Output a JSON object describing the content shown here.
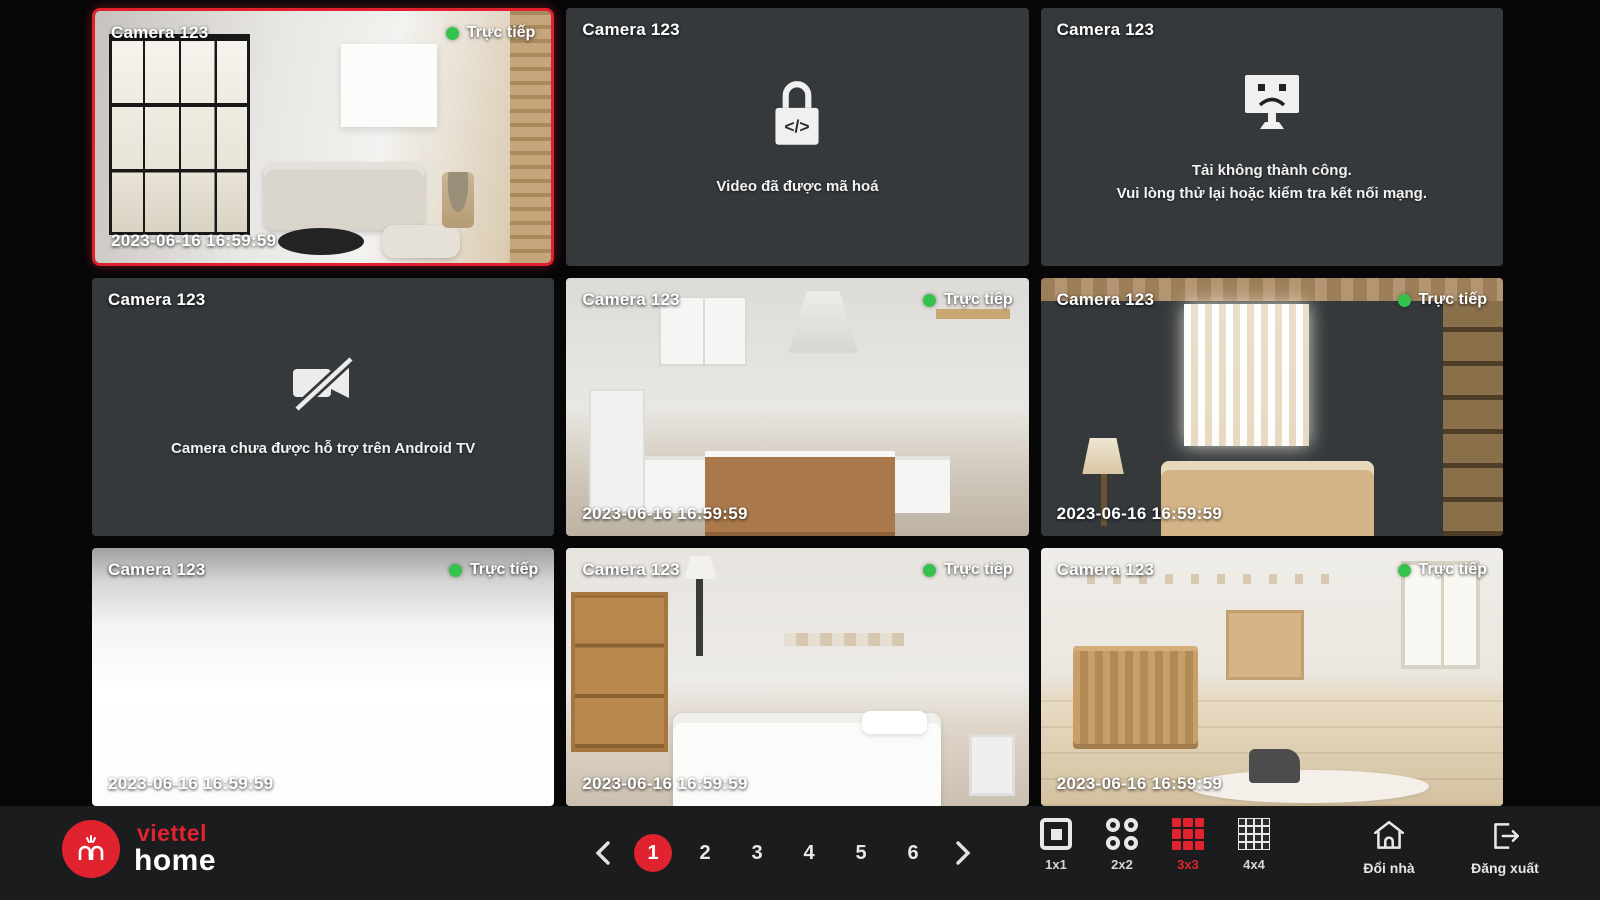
{
  "colors": {
    "accent_red": "#e0232e",
    "live_green": "#35c24c",
    "tile_gray": "#35393c"
  },
  "tiles": [
    {
      "title": "Camera 123",
      "status": "live",
      "status_label": "Trực tiếp",
      "timestamp": "2023-06-16 16:59:59",
      "selected": true
    },
    {
      "title": "Camera 123",
      "status": "encrypted",
      "message": "Video đã được mã hoá"
    },
    {
      "title": "Camera 123",
      "status": "error",
      "message_line1": "Tải không thành công.",
      "message_line2": "Vui lòng thử lại hoặc kiểm tra kết nối mạng."
    },
    {
      "title": "Camera 123",
      "status": "unsupported",
      "message": "Camera chưa được hỗ trợ trên Android TV"
    },
    {
      "title": "Camera 123",
      "status": "live",
      "status_label": "Trực tiếp",
      "timestamp": "2023-06-16 16:59:59"
    },
    {
      "title": "Camera 123",
      "status": "live",
      "status_label": "Trực tiếp",
      "timestamp": "2023-06-16 16:59:59"
    },
    {
      "title": "Camera 123",
      "status": "live",
      "status_label": "Trực tiếp",
      "timestamp": "2023-06-16 16:59:59"
    },
    {
      "title": "Camera 123",
      "status": "live",
      "status_label": "Trực tiếp",
      "timestamp": "2023-06-16 16:59:59"
    },
    {
      "title": "Camera 123",
      "status": "live",
      "status_label": "Trực tiếp",
      "timestamp": "2023-06-16 16:59:59"
    }
  ],
  "icons": {
    "code_glyph": "</>"
  },
  "footer": {
    "brand": {
      "word1": "viettel",
      "word2": "home"
    },
    "pagination": {
      "pages": [
        "1",
        "2",
        "3",
        "4",
        "5",
        "6"
      ],
      "active_page": "1"
    },
    "layouts": [
      {
        "label": "1x1"
      },
      {
        "label": "2x2"
      },
      {
        "label": "3x3",
        "active": true
      },
      {
        "label": "4x4"
      }
    ],
    "actions": {
      "change_home": "Đổi nhà",
      "logout": "Đăng xuất"
    }
  }
}
